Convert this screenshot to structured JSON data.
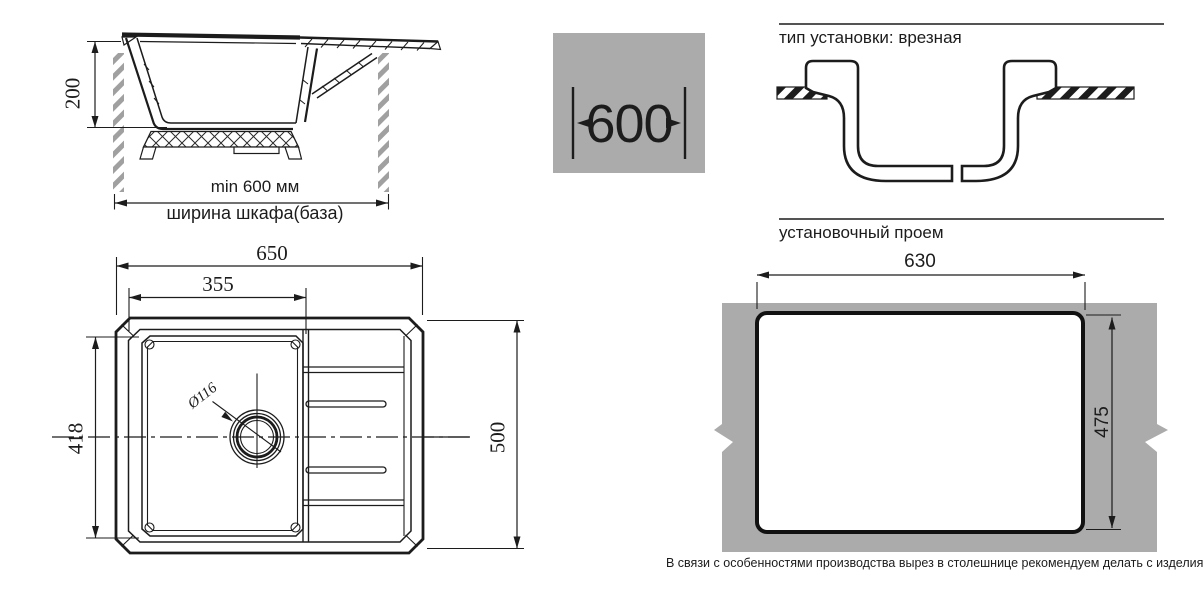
{
  "cabinet_view": {
    "depth_dim": "200",
    "min_width_label": "min 600 мм",
    "cabinet_width_label": "ширина шкафа(база)",
    "badge_width": "600"
  },
  "installation": {
    "heading": "тип установки: врезная"
  },
  "opening": {
    "heading": "установочный проем",
    "width_dim": "630",
    "height_dim": "475",
    "note": "В связи с особенностями производства вырез в столешнице рекомендуем делать с изделия."
  },
  "top_view": {
    "overall_width_dim": "650",
    "bowl_width_dim": "355",
    "bowl_depth_dim": "418",
    "overall_depth_dim": "500",
    "drain_dim": "Ø116"
  },
  "colors": {
    "panel_gray": "#ababab",
    "hatch_gray": "#a0a0a0",
    "line": "#1c1c1c"
  }
}
